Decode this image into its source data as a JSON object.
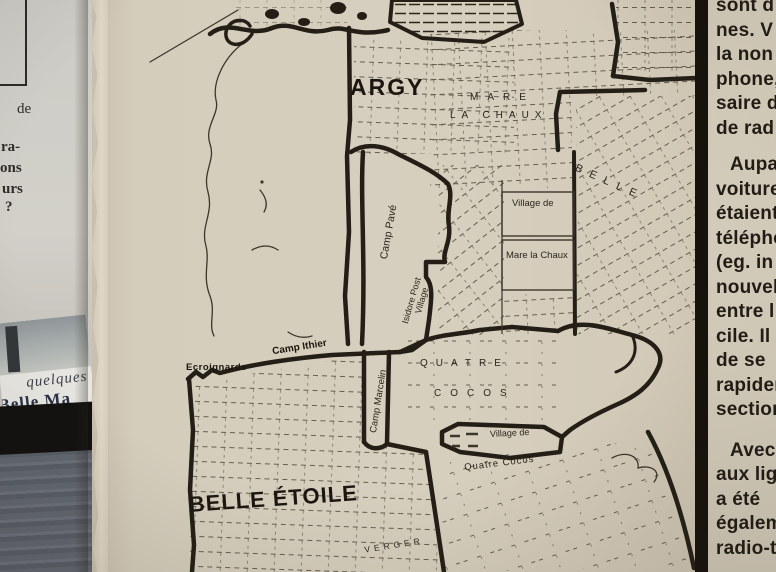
{
  "left_page": {
    "fragments": [
      "de",
      "ra-",
      "ons",
      "urs",
      "?"
    ],
    "caption_line1": "quelques",
    "caption_line2": "Belle Ma"
  },
  "map": {
    "labels": {
      "argy": "ARGY",
      "mare": "MARE",
      "la_chaux": "LA CHAUX",
      "village_de_mare": "Village de",
      "mare_la_chaux": "Mare la Chaux",
      "camp_pave": "Camp Pavé",
      "isidore_post": "Isidore Post",
      "isidore_village": "Village",
      "belle": "BELLE",
      "ecroignarde": "Ecroignarde",
      "camp_ithier": "Camp Ithier",
      "camp_marcelin": "Camp Marcelin",
      "quatre": "QUATRE",
      "cocos": "COCOS",
      "village_de_qc": "Village de",
      "quatre_cocos": "Quatre Cocos",
      "belle_etoile": "BELLE ÉTOILE",
      "verger": "VERGER"
    }
  },
  "article": {
    "lines": [
      "sont d",
      "nes. V",
      "la non",
      "phone,",
      "saire d",
      "de rad",
      "Aupa",
      "voiture",
      "étaient",
      "télépho",
      "(eg. in",
      "nouvell",
      "entre l",
      "cile. Il",
      "de se",
      "rapidem",
      "section",
      "Avec",
      "aux lig",
      "a été",
      "égalem",
      "radio-t"
    ]
  },
  "colors": {
    "newsprint": "#d5cdbc",
    "ink": "#241f16",
    "column_rule": "#15110c"
  }
}
